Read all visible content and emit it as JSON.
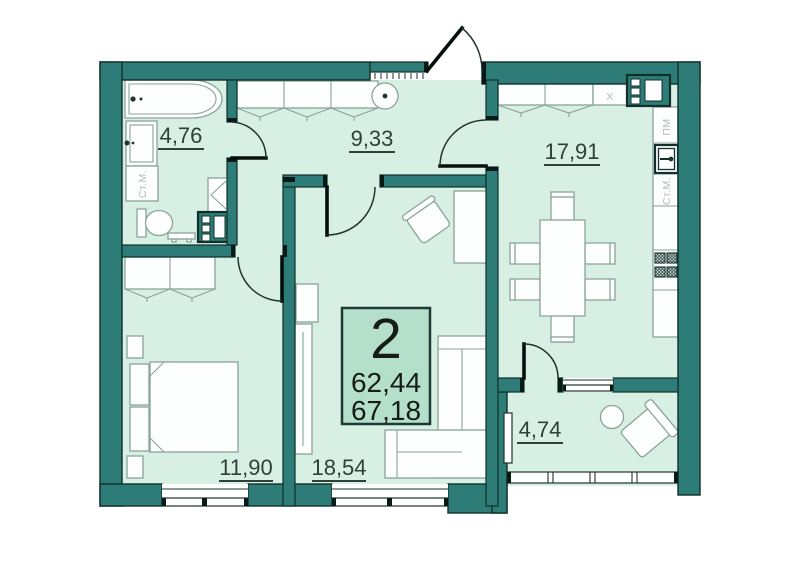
{
  "plan": {
    "apartment_badge": {
      "number": "2",
      "area_living": "62,44",
      "area_total": "67,18"
    },
    "rooms": {
      "bathroom": {
        "area": "4,76"
      },
      "hallway": {
        "area": "9,33"
      },
      "kitchen_living": {
        "area": "17,91"
      },
      "bedroom": {
        "area": "11,90"
      },
      "living": {
        "area": "18,54"
      },
      "balcony": {
        "area": "4,74"
      }
    },
    "appliance_labels": {
      "washer_bathroom": "Ст.М.",
      "dishwasher_kitchen": "ПМ",
      "washer_kitchen": "Ст.М.",
      "fridge": "X"
    },
    "colors": {
      "wall": "#2e7c77",
      "wall_outline": "#11302a",
      "floor": "#d8efe4",
      "badge_fill": "#b4dfca",
      "furniture_outline": "#8ba29a",
      "label_text": "#2e403a"
    }
  }
}
